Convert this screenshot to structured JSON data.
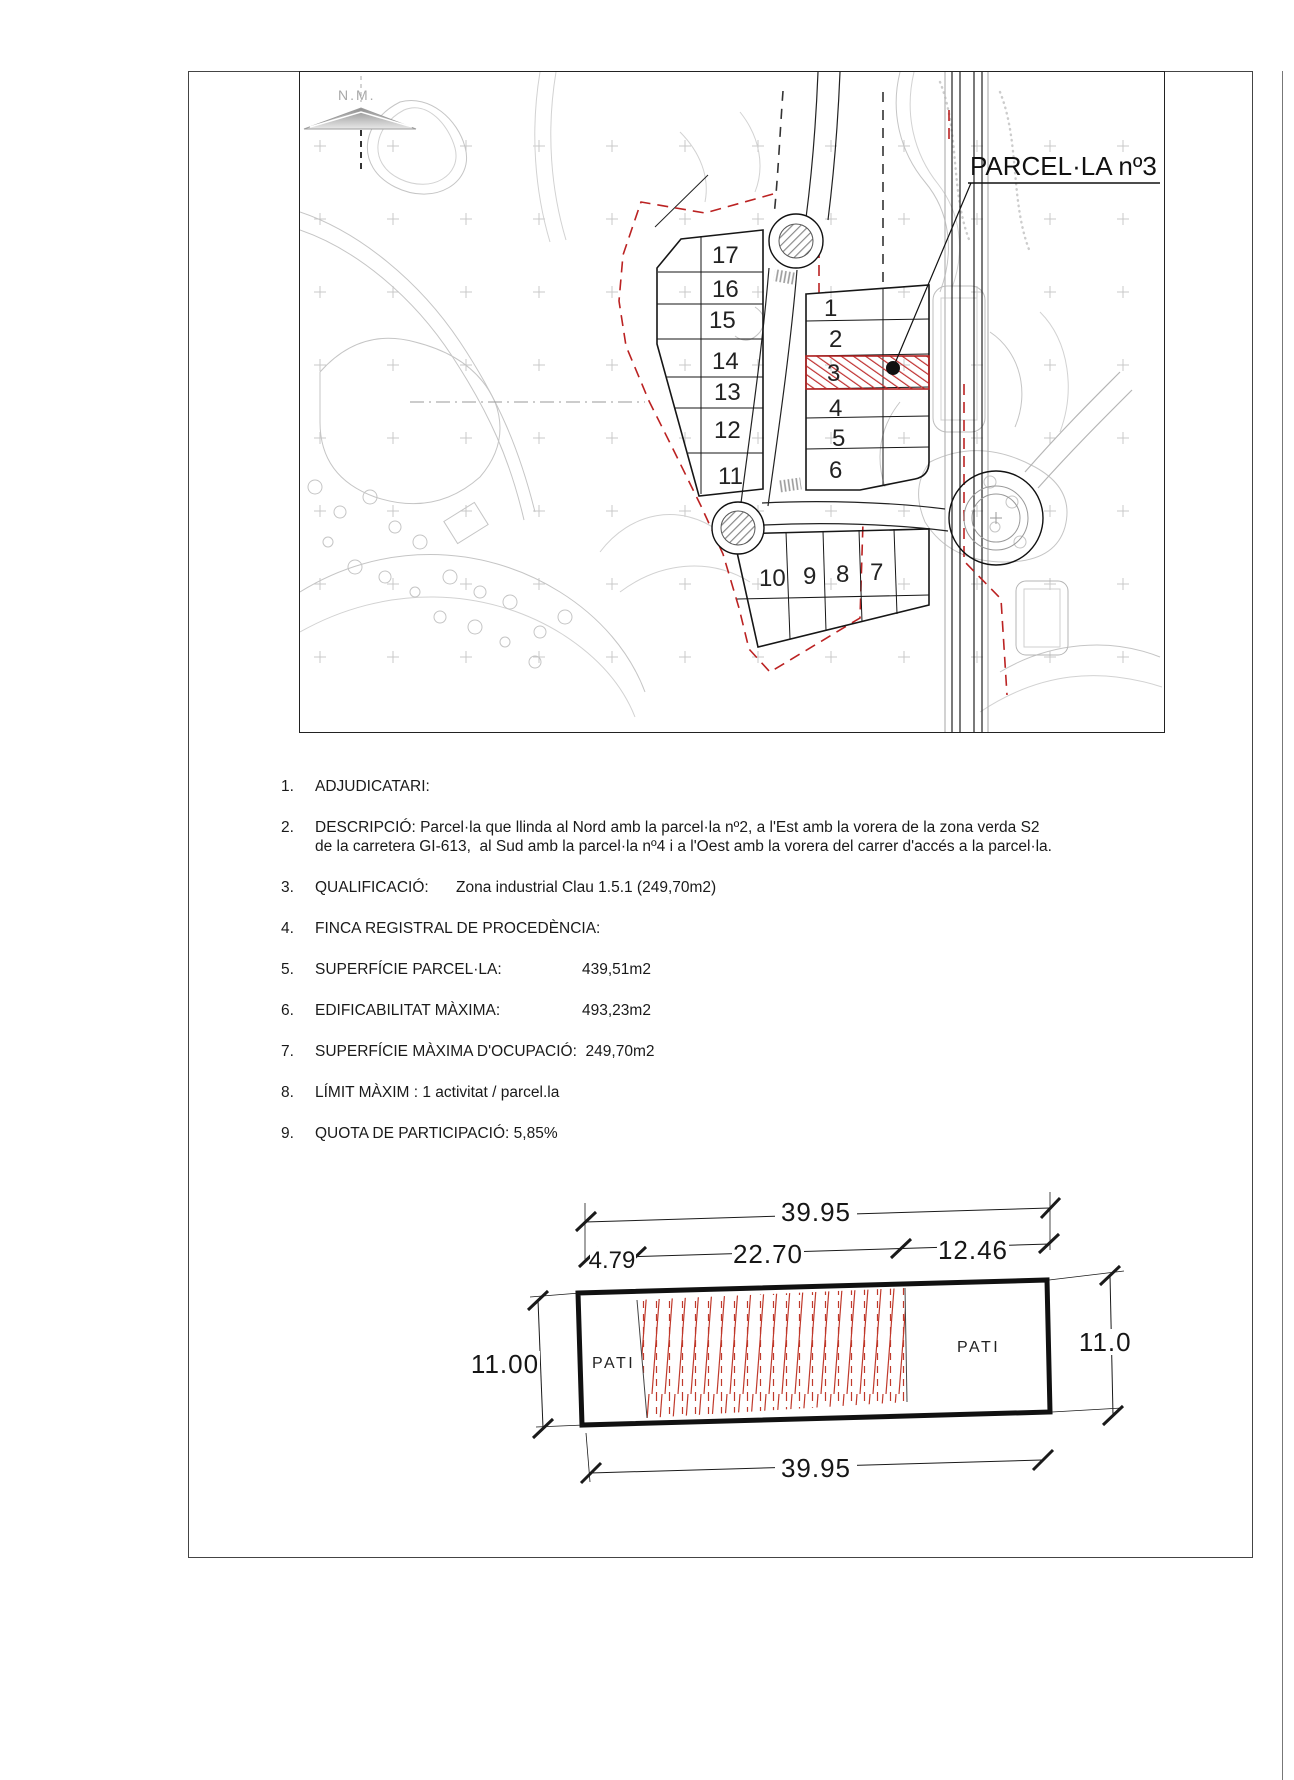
{
  "map": {
    "north_label": "N.M.",
    "parcel_label": "PARCEL·LA nº3",
    "highlighted_parcel": "3",
    "left_block": [
      "17",
      "16",
      "15",
      "14",
      "13",
      "12",
      "11"
    ],
    "right_block": [
      "1",
      "2",
      "3",
      "4",
      "5",
      "6"
    ],
    "south_block": [
      "10",
      "9",
      "8",
      "7"
    ],
    "colors": {
      "boundary_red": "#bb2222",
      "hatch_red": "#c03030",
      "contour_gray": "#c5c5c5"
    }
  },
  "details": {
    "items": [
      {
        "num": "1.",
        "label": "ADJUDICATARI:"
      },
      {
        "num": "2.",
        "label": "DESCRIPCIÓ: Parcel·la que llinda al Nord amb la parcel·la nº2, a l'Est amb la vorera de la zona verda S2",
        "line2": "de la carretera GI-613,  al Sud amb la parcel·la nº4 i a l'Oest amb la vorera del carrer d'accés a la parcel·la."
      },
      {
        "num": "3.",
        "label": "QUALIFICACIÓ:",
        "value": "Zona industrial Clau 1.5.1 (249,70m2)"
      },
      {
        "num": "4.",
        "label": "FINCA REGISTRAL DE PROCEDÈNCIA:"
      },
      {
        "num": "5.",
        "label": "SUPERFÍCIE PARCEL·LA:",
        "value": "439,51m2"
      },
      {
        "num": "6.",
        "label": "EDIFICABILITAT MÀXIMA:",
        "value": "493,23m2"
      },
      {
        "num": "7.",
        "label": "SUPERFÍCIE MÀXIMA D'OCUPACIÓ:",
        "value": "249,70m2"
      },
      {
        "num": "8.",
        "label": "LÍMIT MÀXIM : 1 activitat / parcel.la"
      },
      {
        "num": "9.",
        "label": "QUOTA DE PARTICIPACIÓ: 5,85%"
      }
    ]
  },
  "plan": {
    "width_total_top": "39.95",
    "seg_left": "4.79",
    "seg_mid": "22.70",
    "seg_right": "12.46",
    "height_left": "11.00",
    "height_right": "11.00",
    "width_total_bottom": "39.95",
    "pati_left": "PATI",
    "pati_right": "PATI"
  }
}
